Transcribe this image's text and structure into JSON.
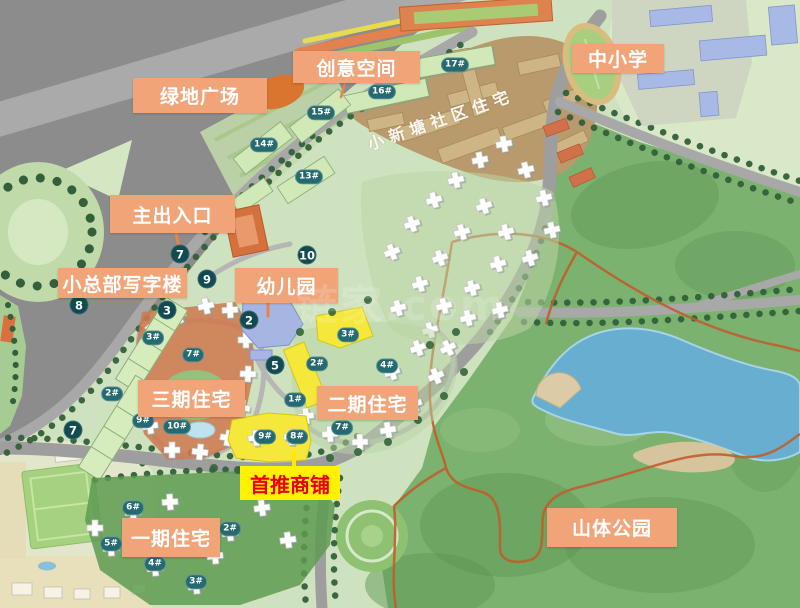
{
  "watermark": "链家.com",
  "district_label": {
    "text": "小新塘社区住宅"
  },
  "area_labels": [
    {
      "name": "label-creative-space",
      "text": "创意空间",
      "x": 293,
      "y": 51,
      "w": 127,
      "h": 32
    },
    {
      "name": "label-green-plaza",
      "text": "绿地广场",
      "x": 133,
      "y": 78,
      "w": 134,
      "h": 35
    },
    {
      "name": "label-primary-middle-school",
      "text": "中小学",
      "x": 572,
      "y": 44,
      "w": 92,
      "h": 29
    },
    {
      "name": "label-main-entrance",
      "text": "主出入口",
      "x": 110,
      "y": 195,
      "w": 125,
      "h": 38
    },
    {
      "name": "label-hq-office",
      "text": "小总部写字楼",
      "x": 58,
      "y": 268,
      "w": 129,
      "h": 30
    },
    {
      "name": "label-kindergarten",
      "text": "幼儿园",
      "x": 235,
      "y": 268,
      "w": 103,
      "h": 35
    },
    {
      "name": "label-phase-3",
      "text": "三期住宅",
      "x": 138,
      "y": 380,
      "w": 107,
      "h": 37
    },
    {
      "name": "label-phase-2",
      "text": "二期住宅",
      "x": 317,
      "y": 386,
      "w": 101,
      "h": 34
    },
    {
      "name": "label-phase-1",
      "text": "一期住宅",
      "x": 122,
      "y": 518,
      "w": 98,
      "h": 39
    },
    {
      "name": "label-mountain-park",
      "text": "山体公园",
      "x": 547,
      "y": 508,
      "w": 130,
      "h": 39
    }
  ],
  "highlight_label": {
    "text": "首推商铺"
  },
  "route_markers": [
    {
      "n": "7",
      "x": 180,
      "y": 254
    },
    {
      "n": "9",
      "x": 207,
      "y": 279
    },
    {
      "n": "10",
      "x": 307,
      "y": 255
    },
    {
      "n": "3",
      "x": 167,
      "y": 310
    },
    {
      "n": "2",
      "x": 249,
      "y": 320
    },
    {
      "n": "5",
      "x": 275,
      "y": 365
    },
    {
      "n": "8",
      "x": 79,
      "y": 305
    },
    {
      "n": "7",
      "x": 73,
      "y": 430
    }
  ],
  "building_badges": [
    {
      "label": "17#",
      "x": 455,
      "y": 65
    },
    {
      "label": "16#",
      "x": 382,
      "y": 92
    },
    {
      "label": "15#",
      "x": 321,
      "y": 113
    },
    {
      "label": "14#",
      "x": 264,
      "y": 145
    },
    {
      "label": "13#",
      "x": 309,
      "y": 177
    },
    {
      "label": "3#",
      "x": 153,
      "y": 338
    },
    {
      "label": "7#",
      "x": 193,
      "y": 355
    },
    {
      "label": "2#",
      "x": 112,
      "y": 394
    },
    {
      "label": "9#",
      "x": 143,
      "y": 421
    },
    {
      "label": "10#",
      "x": 177,
      "y": 427
    },
    {
      "label": "3#",
      "x": 348,
      "y": 335
    },
    {
      "label": "2#",
      "x": 317,
      "y": 364
    },
    {
      "label": "4#",
      "x": 387,
      "y": 366
    },
    {
      "label": "1#",
      "x": 295,
      "y": 400
    },
    {
      "label": "7#",
      "x": 342,
      "y": 428
    },
    {
      "label": "9#",
      "x": 265,
      "y": 437
    },
    {
      "label": "8#",
      "x": 297,
      "y": 437
    },
    {
      "label": "6#",
      "x": 133,
      "y": 508
    },
    {
      "label": "2#",
      "x": 230,
      "y": 529
    },
    {
      "label": "5#",
      "x": 111,
      "y": 544
    },
    {
      "label": "4#",
      "x": 155,
      "y": 564
    },
    {
      "label": "3#",
      "x": 196,
      "y": 582
    }
  ],
  "colors": {
    "area_label_bg": "#F0A478",
    "area_label_text": "#FFFFFF",
    "highlight_bg": "#FFF100",
    "highlight_text": "#E60012",
    "route_marker_bg": "#124A52",
    "building_badge_bg": "#256A70",
    "lake": "#68AED1",
    "mountain_green": "#7CB26F",
    "trail_orange": "#BF5F2E",
    "shop_yellow": "#F5E83B",
    "community_brown": "#B89A6C"
  }
}
